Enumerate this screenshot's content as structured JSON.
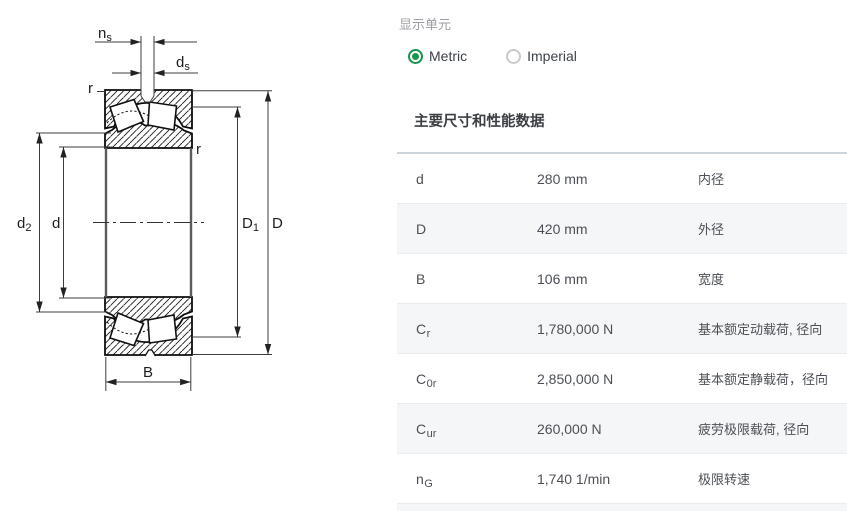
{
  "units_panel": {
    "label": "显示单元",
    "options": [
      {
        "label": "Metric",
        "selected": true
      },
      {
        "label": "Imperial",
        "selected": false
      }
    ]
  },
  "section": {
    "title": "主要尺寸和性能数据"
  },
  "table": {
    "rows": [
      {
        "symbol_base": "d",
        "symbol_sub": "",
        "value": "280 mm",
        "description": "内径"
      },
      {
        "symbol_base": "D",
        "symbol_sub": "",
        "value": "420 mm",
        "description": "外径"
      },
      {
        "symbol_base": "B",
        "symbol_sub": "",
        "value": "106 mm",
        "description": "宽度"
      },
      {
        "symbol_base": "C",
        "symbol_sub": "r",
        "value": "1,780,000 N",
        "description": "基本额定动载荷, 径向"
      },
      {
        "symbol_base": "C",
        "symbol_sub": "0r",
        "value": "2,850,000 N",
        "description": "基本额定静载荷，径向"
      },
      {
        "symbol_base": "C",
        "symbol_sub": "ur",
        "value": "260,000 N",
        "description": "疲劳极限载荷, 径向"
      },
      {
        "symbol_base": "n",
        "symbol_sub": "G",
        "value": "1,740 1/min",
        "description": "极限转速"
      }
    ]
  },
  "drawing": {
    "labels": {
      "ns_base": "n",
      "ns_sub": "s",
      "ds_base": "d",
      "ds_sub": "s",
      "d2_base": "d",
      "d2_sub": "2",
      "d_bore": "d",
      "D1_base": "D",
      "D1_sub": "1",
      "D_outer": "D",
      "B_width": "B",
      "r_top": "r",
      "r_bottom": "r"
    }
  },
  "colors": {
    "accent_green": "#18944a",
    "table_top_border": "#ccd3d9",
    "row_alt_bg": "#f5f6f7",
    "text": "#4c5056"
  }
}
